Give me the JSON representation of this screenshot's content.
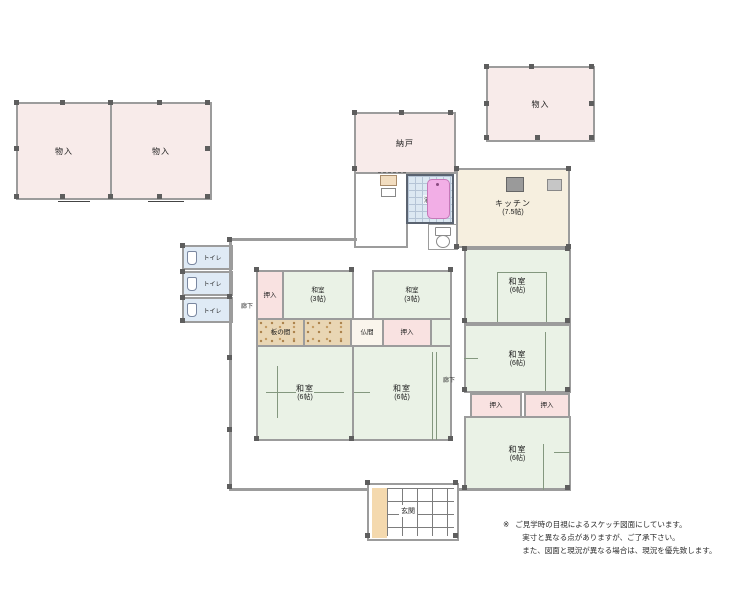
{
  "rooms": {
    "storage_a": {
      "label": "物入"
    },
    "storage_b": {
      "label": "物入"
    },
    "storage_c": {
      "label": "物入"
    },
    "nando": {
      "label": "納戸"
    },
    "bath": {
      "label": "浴室"
    },
    "kitchen": {
      "label": "キッチン",
      "size": "(7.5帖)"
    },
    "toilet_1": {
      "label": "トイレ"
    },
    "toilet_2": {
      "label": "トイレ"
    },
    "toilet_3": {
      "label": "トイレ"
    },
    "closet_nw": {
      "label": "押入"
    },
    "tatami_3_left": {
      "label": "和室",
      "size": "(3帖)"
    },
    "tatami_3_right": {
      "label": "和室",
      "size": "(3帖)"
    },
    "itanoma": {
      "label": "板の間"
    },
    "butsuma": {
      "label": "仏間"
    },
    "closet_mid": {
      "label": "押入"
    },
    "tatami_6_sw": {
      "label": "和室",
      "size": "(6帖)"
    },
    "tatami_6_s": {
      "label": "和室",
      "size": "(6帖)"
    },
    "tatami_6_ne": {
      "label": "和室",
      "size": "(6帖)"
    },
    "tatami_6_e": {
      "label": "和室",
      "size": "(6帖)"
    },
    "tatami_6_se": {
      "label": "和室",
      "size": "(6帖)"
    },
    "closet_e1": {
      "label": "押入"
    },
    "closet_e2": {
      "label": "押入"
    },
    "genkan": {
      "label": "玄関"
    },
    "hall_left": {
      "label": "廊下"
    },
    "hall_right": {
      "label": "廊下"
    }
  },
  "note": {
    "marker": "※",
    "lines": [
      "ご見学時の目視によるスケッチ図面にしています。",
      "実寸と異なる点がありますが、ご了承下さい。",
      "また、図面と現況が異なる場合は、現況を優先致します。"
    ]
  },
  "colors": {
    "storage_pink": "#f8ebea",
    "closet_pink": "#f9e2e1",
    "tatami_green": "#eaf2e6",
    "kitchen_cream": "#f6efdf",
    "toilet_blue": "#dfeaf5",
    "bath_blue": "#dce8f2",
    "tub_pink": "#f2aee6",
    "wood_tan": "#e9d6b4",
    "wall_gray": "#9c9c9c",
    "post_gray": "#5e5e5e"
  }
}
